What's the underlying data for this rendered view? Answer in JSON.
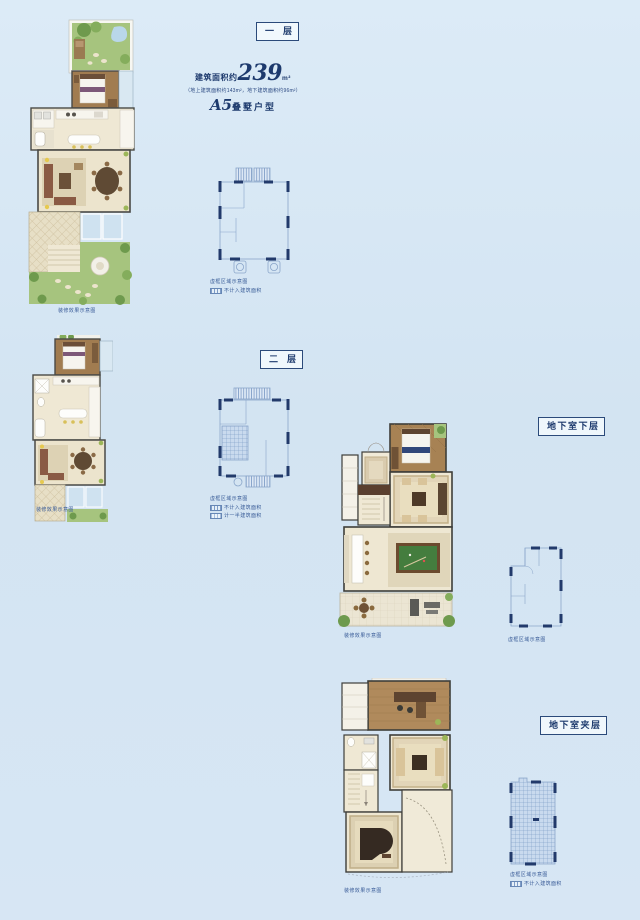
{
  "page": {
    "background": "#d7e6f4"
  },
  "header": {
    "area_prefix": "建筑面积约",
    "area_value": "239",
    "area_unit": "m²",
    "area_detail": "（地上建筑面积约143m²，地下建筑面积约96m²）",
    "model_code": "A5",
    "model_suffix": "叠墅户型"
  },
  "sections": [
    {
      "label": "一层"
    },
    {
      "label": "二层"
    },
    {
      "label": "地下室下层"
    },
    {
      "label": "地下室夹层"
    }
  ],
  "legend": {
    "render_caption": "装修效果示意图",
    "schematic_caption": "虚框区域示意图",
    "not_counted": "不计入建筑面积",
    "half_counted": "计一半建筑面积"
  },
  "colors": {
    "background": "#d7e6f4",
    "navy_text": "#1d3a6d",
    "schematic_wall": "#223a6b",
    "schematic_line": "#8ba6ca",
    "lawn_green": "#a6c47e",
    "tree_green": "#6e9a4d",
    "wood_floor": "#a17c50",
    "cream_floor": "#efe8d4",
    "rug_tan": "#e2d5b8",
    "sofa_brown": "#8a5a44",
    "billiard_green": "#447d3e",
    "glass_blue": "#cfe2f0"
  }
}
